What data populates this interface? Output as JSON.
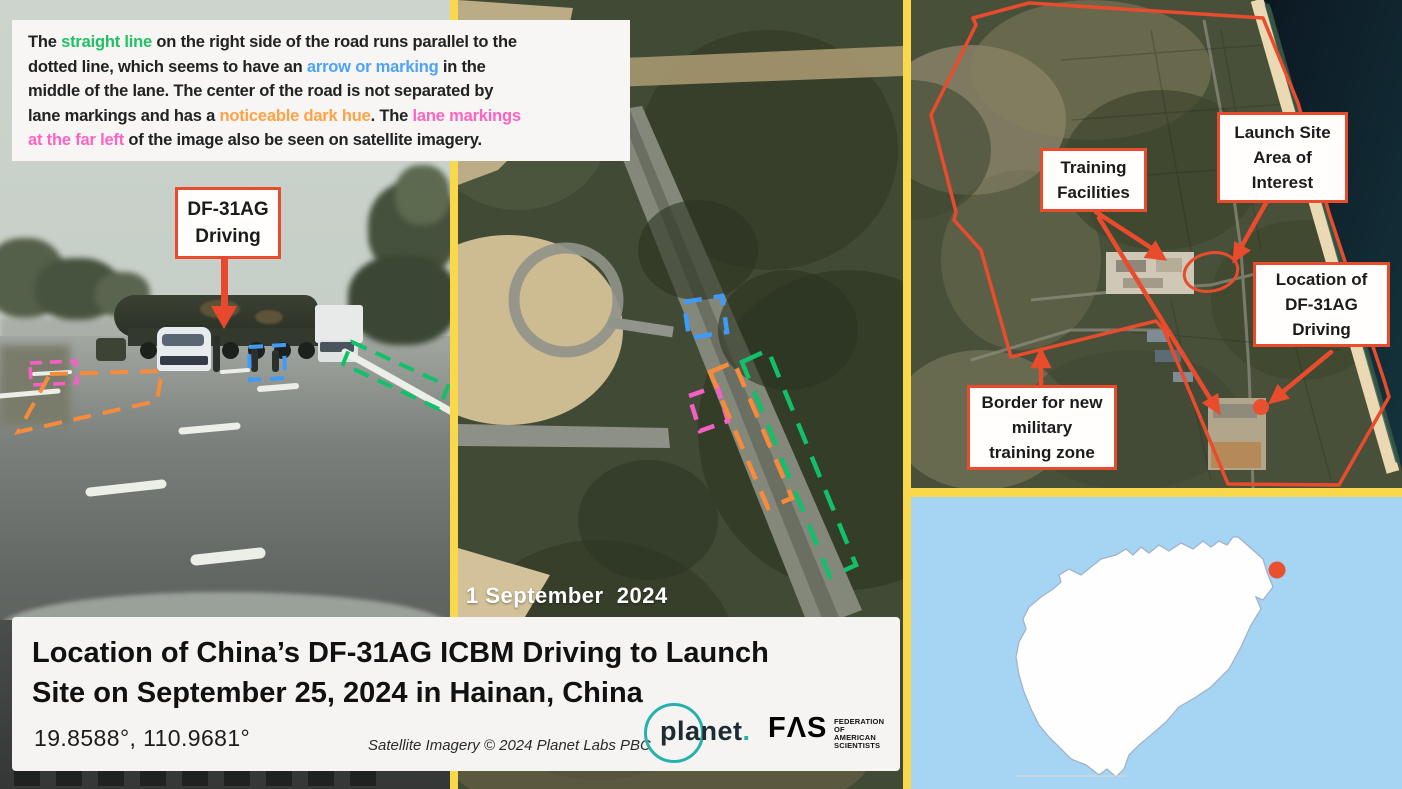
{
  "note": {
    "lines": [
      [
        {
          "t": "The ",
          "c": "dark"
        },
        {
          "t": "straight line",
          "c": "green"
        },
        {
          "t": " on the right side of the road runs parallel to the",
          "c": "dark"
        }
      ],
      [
        {
          "t": "dotted line, which seems to have an ",
          "c": "dark"
        },
        {
          "t": "arrow or marking",
          "c": "blue"
        },
        {
          "t": " in the",
          "c": "dark"
        }
      ],
      [
        {
          "t": "middle of the lane. The center of the road is not separated by",
          "c": "dark"
        }
      ],
      [
        {
          "t": "lane markings and has a ",
          "c": "dark"
        },
        {
          "t": "noticeable dark hue",
          "c": "orange"
        },
        {
          "t": ". The ",
          "c": "dark"
        },
        {
          "t": "lane markings",
          "c": "pink"
        }
      ],
      [
        {
          "t": "at the far left",
          "c": "pink"
        },
        {
          "t": " of the image also be seen on satellite imagery.",
          "c": "dark"
        }
      ]
    ]
  },
  "photo_label": {
    "lines": [
      "DF-31AG",
      "Driving"
    ]
  },
  "middle_panel": {
    "date": "1 September  2024"
  },
  "right_panel": {
    "labels": [
      {
        "lines": [
          "Training",
          "Facilities"
        ]
      },
      {
        "lines": [
          "Launch Site",
          "Area of",
          "Interest"
        ]
      },
      {
        "lines": [
          "Location of",
          "DF-31AG",
          "Driving"
        ]
      },
      {
        "lines": [
          "Border for new",
          "military",
          "training zone"
        ]
      }
    ]
  },
  "footer": {
    "title_line1": "Location of China’s DF-31AG ICBM Driving to Launch",
    "title_line2": "Site on September 25, 2024 in Hainan, China",
    "coordinates": "19.8588°, 110.9681°",
    "attribution": "Satellite Imagery © 2024 Planet Labs PBC",
    "planet_text": "planet",
    "planet_dot": ".",
    "fas_text": "FΛS",
    "fas_sub": [
      "FEDERATION",
      "OF AMERICAN",
      "SCIENTISTS"
    ]
  },
  "colors": {
    "annotation_red": "#e94c2d",
    "divider_yellow": "#f9d84c",
    "dash_green": "#12c06a",
    "dash_blue": "#3f9bf7",
    "dash_orange": "#f78b3c",
    "dash_pink": "#f85fc6",
    "note_green": "#21c063",
    "note_blue": "#4da3f7",
    "note_orange": "#ffa245",
    "note_pink": "#ff63c1",
    "planet_teal": "#26b1ab",
    "map_sea_blue": "#a5d5f3",
    "location_dot_red": "#e8502f"
  }
}
